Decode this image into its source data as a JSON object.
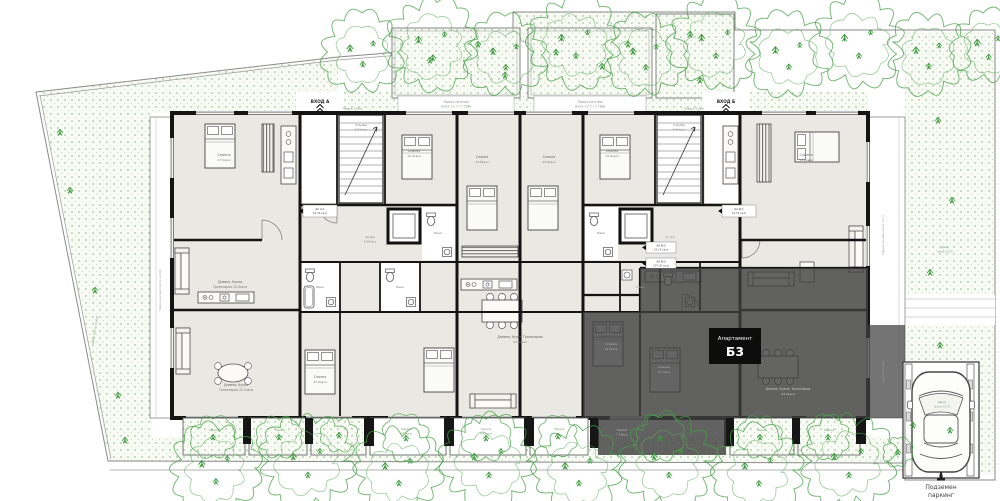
{
  "badge": {
    "title": "Апартамент",
    "number": "Б3"
  },
  "parking": {
    "line1": "Подземен",
    "line2": "паркинг"
  },
  "entrances": {
    "a": "ВХОД A",
    "b": "ВХОД Б"
  },
  "colors": {
    "wall": "#141414",
    "room_fill": "#e9e8e2",
    "white_room": "#ffffff",
    "highlight_overlay": "#3f3f3f",
    "badge_bg": "#0d0d0d",
    "badge_text": "#ffffff",
    "vegetation": "#44a044",
    "stipple_dot": "#6a9a6a",
    "boundary": "#8a8a8a"
  },
  "icons": {
    "tree": "cloud-scribble",
    "bush": "small-cloud-scribble",
    "sprig": "grass-mark",
    "car": "car-top-view",
    "bed": "double-bed",
    "sofa": "sofa",
    "dining_table": "table-with-chairs",
    "kitchen": "kitchen-counter",
    "toilet": "toilet",
    "sink": "sink",
    "bathtub": "bathtub",
    "stairs": "stair-flight",
    "elevator": "elevator-shaft",
    "wardrobe": "hatched-wardrobe",
    "entrance": "entrance-chevron",
    "parking_entrance": "parking-entrance-glyph"
  },
  "plan": {
    "labels": [
      {
        "t": "ВХОД A",
        "x": 320,
        "y": 103,
        "s": 4.2,
        "c": "#222222",
        "w": "bold",
        "n": "entrance-a-label"
      },
      {
        "t": "ВХОД Б",
        "x": 726,
        "y": 103,
        "s": 4.2,
        "c": "#222222",
        "w": "bold",
        "n": "entrance-b-label"
      },
      {
        "t": "Тераса на етаж",
        "x": 456,
        "y": 103,
        "s": 3.1,
        "c": "#7f977f"
      },
      {
        "t": "(кота +2.7 / 7.78м)",
        "x": 456,
        "y": 107.5,
        "s": 3.1,
        "c": "#7f977f"
      },
      {
        "t": "Тераса на етаж",
        "x": 590,
        "y": 103,
        "s": 3.1,
        "c": "#7f977f"
      },
      {
        "t": "(кота +2.7 / 7.78м)",
        "x": 590,
        "y": 107.5,
        "s": 3.1,
        "c": "#7f977f"
      },
      {
        "t": "Тераса 2.96м",
        "x": 352,
        "y": 109.5,
        "s": 2.8,
        "c": "#888888"
      },
      {
        "t": "Тераса 2.96м",
        "x": 694,
        "y": 109.5,
        "s": 2.8,
        "c": "#888888"
      },
      {
        "t": "Спалня",
        "x": 224,
        "y": 156,
        "s": 3.4,
        "c": "#5f5f5f"
      },
      {
        "t": "17.5кв.м",
        "x": 224,
        "y": 161,
        "s": 3.0,
        "c": "#777777"
      },
      {
        "t": "Спалня",
        "x": 414,
        "y": 152,
        "s": 3.2,
        "c": "#5f5f5f"
      },
      {
        "t": "12.9кв.м",
        "x": 414,
        "y": 157,
        "s": 3.0,
        "c": "#777777"
      },
      {
        "t": "Спалня",
        "x": 482,
        "y": 158,
        "s": 3.2,
        "c": "#5f5f5f"
      },
      {
        "t": "13.8кв.м",
        "x": 482,
        "y": 163,
        "s": 3.0,
        "c": "#777777"
      },
      {
        "t": "Спалня",
        "x": 549,
        "y": 158,
        "s": 3.2,
        "c": "#5f5f5f"
      },
      {
        "t": "13.8кв.м",
        "x": 549,
        "y": 163,
        "s": 3.0,
        "c": "#777777"
      },
      {
        "t": "Спалня",
        "x": 612,
        "y": 152,
        "s": 3.2,
        "c": "#5f5f5f"
      },
      {
        "t": "12.9кв.м",
        "x": 612,
        "y": 157,
        "s": 3.0,
        "c": "#777777"
      },
      {
        "t": "Спалня",
        "x": 806,
        "y": 156,
        "s": 3.4,
        "c": "#5f5f5f"
      },
      {
        "t": "14.9кв.м",
        "x": 806,
        "y": 161,
        "s": 3.0,
        "c": "#777777"
      },
      {
        "t": "Дневна, Кухня",
        "x": 230,
        "y": 283,
        "s": 3.1,
        "c": "#5f5f5f"
      },
      {
        "t": "Трапезария 24.3кв.м",
        "x": 230,
        "y": 288,
        "s": 3.1,
        "c": "#777777"
      },
      {
        "t": "Дневна, Кухня Трапезария",
        "x": 520,
        "y": 338,
        "s": 3.2,
        "c": "#5f5f5f"
      },
      {
        "t": "23.6кв.м",
        "x": 520,
        "y": 343,
        "s": 3.0,
        "c": "#777777"
      },
      {
        "t": "Дневна, Кухня, Трапезария",
        "x": 788,
        "y": 390,
        "s": 3.1,
        "c": "#c8c8c4"
      },
      {
        "t": "24.9кв.м",
        "x": 788,
        "y": 395,
        "s": 3.0,
        "c": "#c8c8c4"
      },
      {
        "t": "Спалня",
        "x": 320,
        "y": 378,
        "s": 3.2,
        "c": "#5f5f5f"
      },
      {
        "t": "15.6кв.м",
        "x": 320,
        "y": 383,
        "s": 3.0,
        "c": "#777777"
      },
      {
        "t": "Дневна, Кухня",
        "x": 236,
        "y": 386,
        "s": 3.1,
        "c": "#5f5f5f"
      },
      {
        "t": "Трапезария 22.1кв.м",
        "x": 236,
        "y": 391,
        "s": 3.1,
        "c": "#777777"
      },
      {
        "t": "Стълби",
        "x": 361,
        "y": 126,
        "s": 3.0,
        "c": "#6a6a6a"
      },
      {
        "t": "8.93кв.м",
        "x": 361,
        "y": 130.5,
        "s": 2.8,
        "c": "#888888"
      },
      {
        "t": "Стълби",
        "x": 679,
        "y": 126,
        "s": 3.0,
        "c": "#6a6a6a"
      },
      {
        "t": "8.93кв.м",
        "x": 679,
        "y": 130.5,
        "s": 2.8,
        "c": "#888888"
      },
      {
        "t": "Баня",
        "x": 320,
        "y": 288,
        "s": 2.9,
        "c": "#777777"
      },
      {
        "t": "Баня",
        "x": 400,
        "y": 288,
        "s": 2.9,
        "c": "#777777"
      },
      {
        "t": "Баня",
        "x": 438,
        "y": 234,
        "s": 2.9,
        "c": "#777777"
      },
      {
        "t": "Баня",
        "x": 601,
        "y": 234,
        "s": 2.9,
        "c": "#777777"
      },
      {
        "t": "Мокро",
        "x": 640,
        "y": 288,
        "s": 2.8,
        "c": "#aaaaaa"
      },
      {
        "t": "Антре",
        "x": 370,
        "y": 238,
        "s": 3.0,
        "c": "#777777"
      },
      {
        "t": "8.06кв.м",
        "x": 370,
        "y": 242.5,
        "s": 2.8,
        "c": "#888888"
      },
      {
        "t": "Антре",
        "x": 670,
        "y": 238,
        "s": 3.0,
        "c": "#9a9a9a"
      },
      {
        "t": "Спалня",
        "x": 611,
        "y": 345,
        "s": 3.0,
        "c": "#b5b5b3"
      },
      {
        "t": "15.0кв.м",
        "x": 611,
        "y": 350,
        "s": 2.8,
        "c": "#b5b5b3"
      },
      {
        "t": "Спалня",
        "x": 664,
        "y": 368,
        "s": 3.0,
        "c": "#b5b5b3"
      },
      {
        "t": "11.7кв.м",
        "x": 664,
        "y": 373,
        "s": 2.8,
        "c": "#b5b5b3"
      },
      {
        "t": "Ап А-1",
        "x": 320,
        "y": 210,
        "s": 2.8,
        "c": "#333333"
      },
      {
        "t": "61.39 кв.м",
        "x": 320,
        "y": 214,
        "s": 2.6,
        "c": "#555555"
      },
      {
        "t": "Ап Б-1",
        "x": 739,
        "y": 210,
        "s": 2.8,
        "c": "#333333"
      },
      {
        "t": "61.39 кв.м",
        "x": 739,
        "y": 214,
        "s": 2.6,
        "c": "#555555"
      },
      {
        "t": "Ап Б-2",
        "x": 661,
        "y": 246.5,
        "s": 2.8,
        "c": "#333333"
      },
      {
        "t": "55.25 кв.м",
        "x": 661,
        "y": 250.5,
        "s": 2.6,
        "c": "#555555"
      },
      {
        "t": "Ап Б-3",
        "x": 661,
        "y": 262.5,
        "s": 2.8,
        "c": "#333333"
      },
      {
        "t": "107.30 кв.м",
        "x": 661,
        "y": 266.5,
        "s": 2.6,
        "c": "#555555"
      },
      {
        "t": "Тераса",
        "x": 214,
        "y": 431,
        "s": 2.9,
        "c": "#6f9c6f"
      },
      {
        "t": "Тераса",
        "x": 280,
        "y": 431,
        "s": 2.9,
        "c": "#6f9c6f"
      },
      {
        "t": "Тераса",
        "x": 406,
        "y": 430,
        "s": 2.9,
        "c": "#6f9c6f"
      },
      {
        "t": "4.63кв.м",
        "x": 406,
        "y": 434.5,
        "s": 2.7,
        "c": "#6f9c6f"
      },
      {
        "t": "Тераса",
        "x": 486,
        "y": 430,
        "s": 2.9,
        "c": "#6f9c6f"
      },
      {
        "t": "4.63кв.м",
        "x": 486,
        "y": 434.5,
        "s": 2.7,
        "c": "#6f9c6f"
      },
      {
        "t": "Тераса",
        "x": 559,
        "y": 430,
        "s": 2.9,
        "c": "#6f9c6f"
      },
      {
        "t": "Тераса",
        "x": 622,
        "y": 431,
        "s": 2.9,
        "c": "#b9b9b9"
      },
      {
        "t": "7.14кв.м",
        "x": 622,
        "y": 435.5,
        "s": 2.7,
        "c": "#b9b9b9"
      },
      {
        "t": "Тераса",
        "x": 762,
        "y": 431,
        "s": 2.9,
        "c": "#6f9c6f"
      },
      {
        "t": "Тераса",
        "x": 829,
        "y": 431,
        "s": 2.9,
        "c": "#6f9c6f"
      },
      {
        "t": "Тераса на ниво (кота +2.7)",
        "x": 884,
        "y": 235,
        "s": 2.8,
        "c": "#8aa08a",
        "r": -90
      },
      {
        "t": "Тераса на ниво",
        "x": 884,
        "y": 372,
        "s": 2.8,
        "c": "#9d9d9d",
        "r": -90
      },
      {
        "t": "Тераса на ниво (кота +0.00)",
        "x": 161,
        "y": 290,
        "s": 2.8,
        "c": "#999999",
        "r": -90
      },
      {
        "t": "Двор (кота +0.00)",
        "x": 96,
        "y": 330,
        "s": 3.0,
        "c": "#7fa37f",
        "r": -80
      },
      {
        "t": "Двор",
        "x": 945,
        "y": 248,
        "s": 3.0,
        "c": "#7fa37f"
      },
      {
        "t": "(кота +2.7)",
        "x": 945,
        "y": 252.5,
        "s": 2.8,
        "c": "#7fa37f"
      },
      {
        "t": "Двор",
        "x": 942,
        "y": 403,
        "s": 3.0,
        "c": "#7fa37f"
      },
      {
        "t": "(кота +2.7)",
        "x": 942,
        "y": 407.5,
        "s": 2.8,
        "c": "#7fa37f"
      }
    ],
    "trees": {
      "top": [
        [
          362,
          52,
          40
        ],
        [
          432,
          44,
          45
        ],
        [
          505,
          55,
          40
        ],
        [
          575,
          42,
          45
        ],
        [
          645,
          55,
          40
        ],
        [
          715,
          42,
          45
        ],
        [
          788,
          54,
          42
        ],
        [
          858,
          42,
          45
        ],
        [
          928,
          54,
          40
        ],
        [
          988,
          46,
          36
        ]
      ],
      "bottom": [
        [
          215,
          468,
          44
        ],
        [
          307,
          461,
          46
        ],
        [
          398,
          470,
          43
        ],
        [
          488,
          461,
          46
        ],
        [
          578,
          470,
          43
        ],
        [
          668,
          461,
          46
        ],
        [
          758,
          470,
          44
        ],
        [
          848,
          461,
          46
        ]
      ],
      "bushes": [
        [
          213,
          437,
          22
        ],
        [
          279,
          437,
          22
        ],
        [
          339,
          435,
          18
        ],
        [
          406,
          438,
          24
        ],
        [
          486,
          438,
          24
        ],
        [
          558,
          436,
          20
        ],
        [
          660,
          438,
          24
        ],
        [
          760,
          437,
          22
        ],
        [
          828,
          437,
          22
        ],
        [
          898,
          452,
          15
        ]
      ]
    }
  }
}
